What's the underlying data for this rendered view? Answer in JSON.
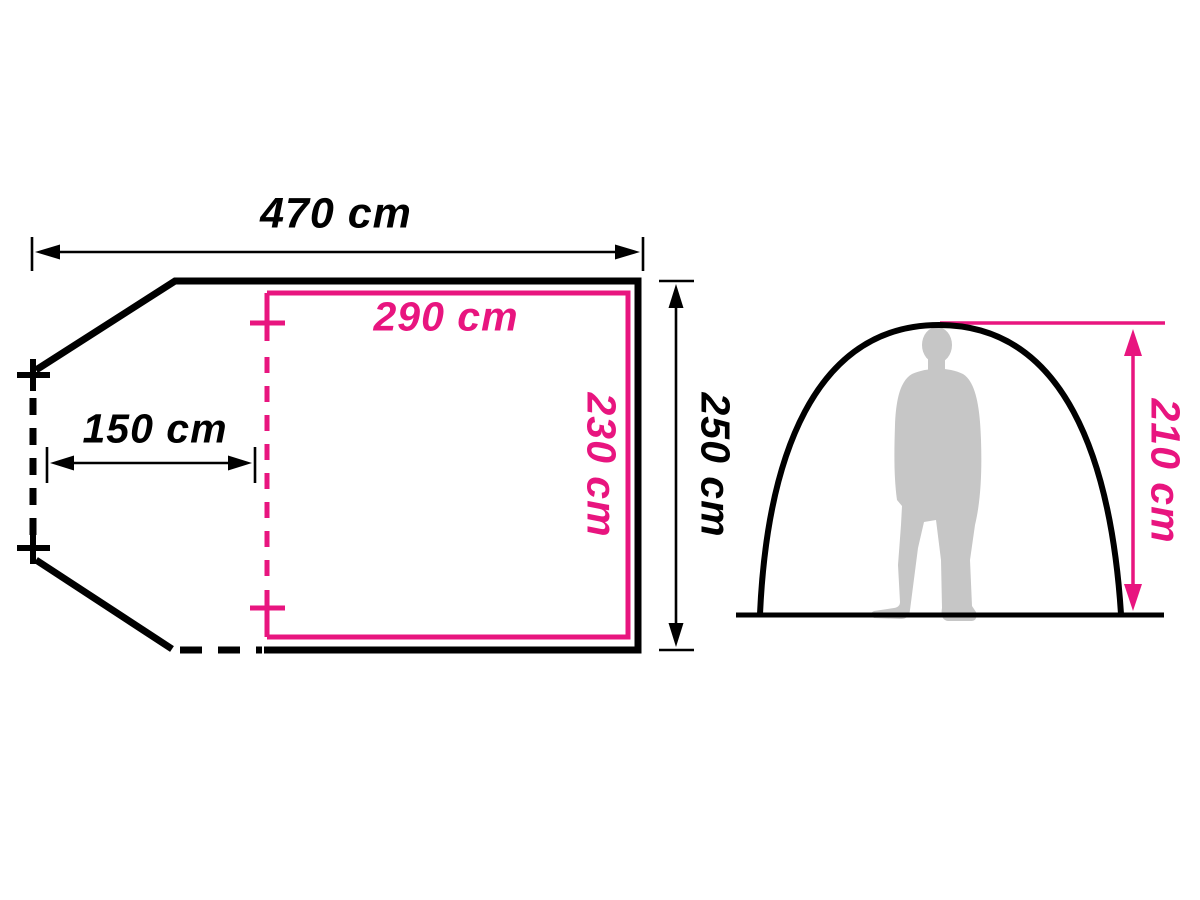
{
  "title": "Tent dimensions diagram",
  "colors": {
    "line": "#000000",
    "accent_pink": "#e8157f",
    "silhouette_gray": "#c6c6c6",
    "background": "#ffffff"
  },
  "floor_plan": {
    "total_width": "470 cm",
    "vestibule_depth": "150 cm",
    "total_depth": "250 cm",
    "inner_width": "290 cm",
    "inner_depth": "230 cm"
  },
  "side_view": {
    "peak_height": "210 cm"
  },
  "values_cm": {
    "total_width": 470,
    "vestibule_depth": 150,
    "total_depth": 250,
    "inner_width": 290,
    "inner_depth": 230,
    "peak_height": 210
  }
}
